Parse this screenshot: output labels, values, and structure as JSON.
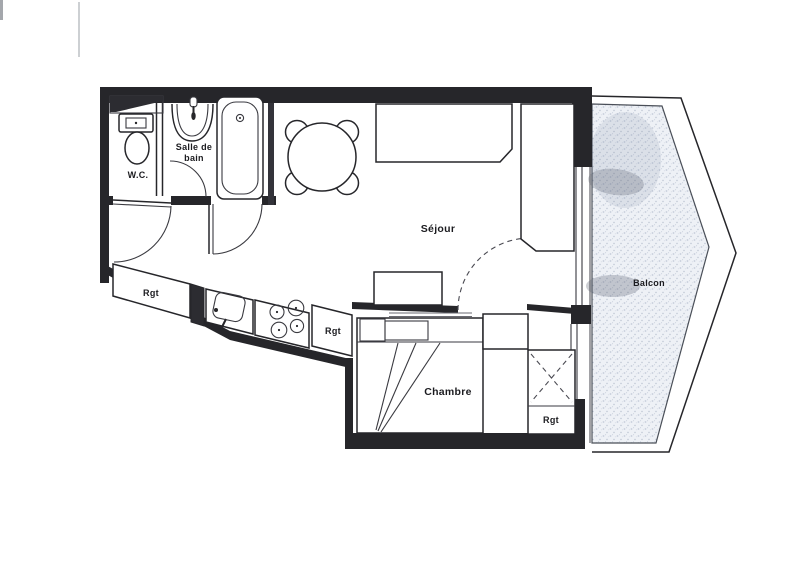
{
  "plan": {
    "type": "apartment-floor-plan",
    "rooms": {
      "wc": {
        "label": "W.C."
      },
      "bathroom": {
        "label_line1": "Salle de",
        "label_line2": "bain"
      },
      "living": {
        "label": "Séjour"
      },
      "bedroom": {
        "label": "Chambre"
      },
      "balcony": {
        "label": "Balcon"
      }
    },
    "storage": {
      "kitchen_left": {
        "label": "Rgt"
      },
      "kitchen_right": {
        "label": "Rgt"
      },
      "bedroom": {
        "label": "Rgt"
      }
    },
    "colors": {
      "ink": "#26262a",
      "paper": "#ffffff",
      "balcony_speckle": "#93a0b8"
    }
  }
}
